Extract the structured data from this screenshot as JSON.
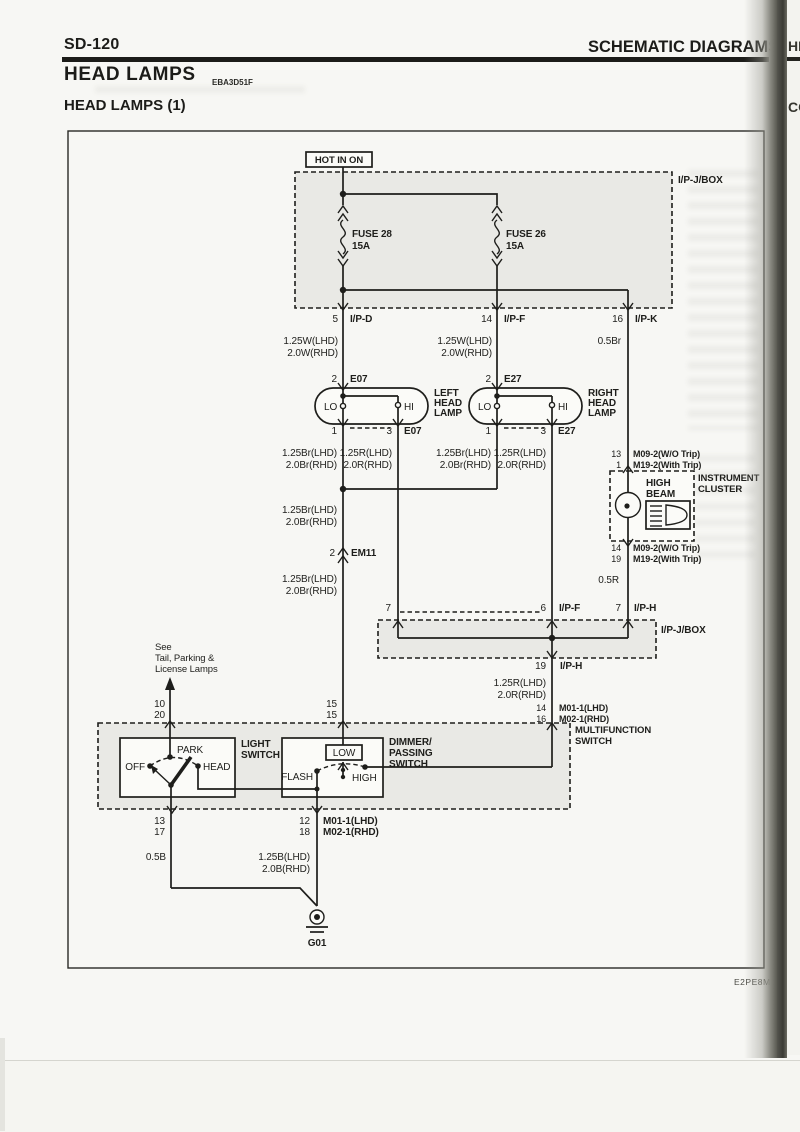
{
  "header": {
    "page_number": "SD-120",
    "section_title": "SCHEMATIC DIAGRAMS",
    "title": "HEAD LAMPS",
    "title_code": "EBA3D51F",
    "subtitle": "HEAD LAMPS (1)",
    "footer_code": "E2PE8M"
  },
  "edge": {
    "tab_top": "HE",
    "tab_bottom": "CO"
  },
  "colors": {
    "ink": "#1e1e1b",
    "paper": "#f7f7f4",
    "box_shade": "#e9e9e5"
  },
  "power": {
    "hot": "HOT IN ON",
    "box": "I/P-J/BOX",
    "fuse1_name": "FUSE 28",
    "fuse1_amp": "15A",
    "fuse2_name": "FUSE 26",
    "fuse2_amp": "15A",
    "out1_pin": "5",
    "out1": "I/P-D",
    "out2_pin": "14",
    "out2": "I/P-F",
    "out3_pin": "16",
    "out3": "I/P-K",
    "w1a": "1.25W(LHD)",
    "w1b": "2.0W(RHD)",
    "w2a": "1.25W(LHD)",
    "w2b": "2.0W(RHD)",
    "w3": "0.5Br"
  },
  "lamp_left": {
    "pin_top": "2",
    "conn": "E07",
    "n1": "LEFT",
    "n2": "HEAD",
    "n3": "LAMP",
    "lo": "LO",
    "hi": "HI",
    "pin_lo": "1",
    "pin_hi": "3",
    "wa1": "1.25Br(LHD)",
    "wa2": "2.0Br(RHD)",
    "wb1": "1.25R(LHD)",
    "wb2": "2.0R(RHD)"
  },
  "lamp_right": {
    "pin_top": "2",
    "conn": "E27",
    "n1": "RIGHT",
    "n2": "HEAD",
    "n3": "LAMP",
    "lo": "LO",
    "hi": "HI",
    "pin_lo": "1",
    "pin_hi": "3",
    "wa1": "1.25Br(LHD)",
    "wa2": "2.0Br(RHD)",
    "wb1": "1.25R(LHD)",
    "wb2": "2.0R(RHD)"
  },
  "em11": {
    "w_above1": "1.25Br(LHD)",
    "w_above2": "2.0Br(RHD)",
    "pin": "2",
    "name": "EM11",
    "w_below1": "1.25Br(LHD)",
    "w_below2": "2.0Br(RHD)"
  },
  "cluster": {
    "pin_t1": "13",
    "conn_t1": "M09-2(W/O Trip)",
    "pin_t2": "1",
    "conn_t2": "M19-2(With Trip)",
    "label1": "INSTRUMENT",
    "label2": "CLUSTER",
    "ind1": "HIGH",
    "ind2": "BEAM",
    "pin_b1": "14",
    "conn_b1": "M09-2(W/O Trip)",
    "pin_b2": "19",
    "conn_b2": "M19-2(With Trip)",
    "wire": "0.5R"
  },
  "midbox": {
    "label": "I/P-J/BOX",
    "p1_pin": "7",
    "p2_pin": "6",
    "p2": "I/P-F",
    "p3_pin": "7",
    "p3": "I/P-H",
    "out_pin": "19",
    "out": "I/P-H",
    "w1": "1.25R(LHD)",
    "w2": "2.0R(RHD)",
    "c1_pin": "14",
    "c1": "M01-1(LHD)",
    "c2_pin": "16",
    "c2": "M02-1(RHD)"
  },
  "mfs": {
    "note1": "See",
    "note2": "Tail, Parking &",
    "note3": "License Lamps",
    "pl1": "10",
    "pl2": "20",
    "pm1": "15",
    "pm2": "15",
    "label1": "MULTIFUNCTION",
    "label2": "SWITCH",
    "ls1": "LIGHT",
    "ls2": "SWITCH",
    "off": "OFF",
    "park": "PARK",
    "head": "HEAD",
    "ds1": "DIMMER/",
    "ds2": "PASSING",
    "ds3": "SWITCH",
    "flash": "FLASH",
    "low": "LOW",
    "high": "HIGH",
    "ob1": "13",
    "ob2": "17",
    "om1_pin": "12",
    "om1": "M01-1(LHD)",
    "om2_pin": "18",
    "om2": "M02-1(RHD)"
  },
  "ground": {
    "w_left": "0.5B",
    "w_r1": "1.25B(LHD)",
    "w_r2": "2.0B(RHD)",
    "name": "G01"
  }
}
